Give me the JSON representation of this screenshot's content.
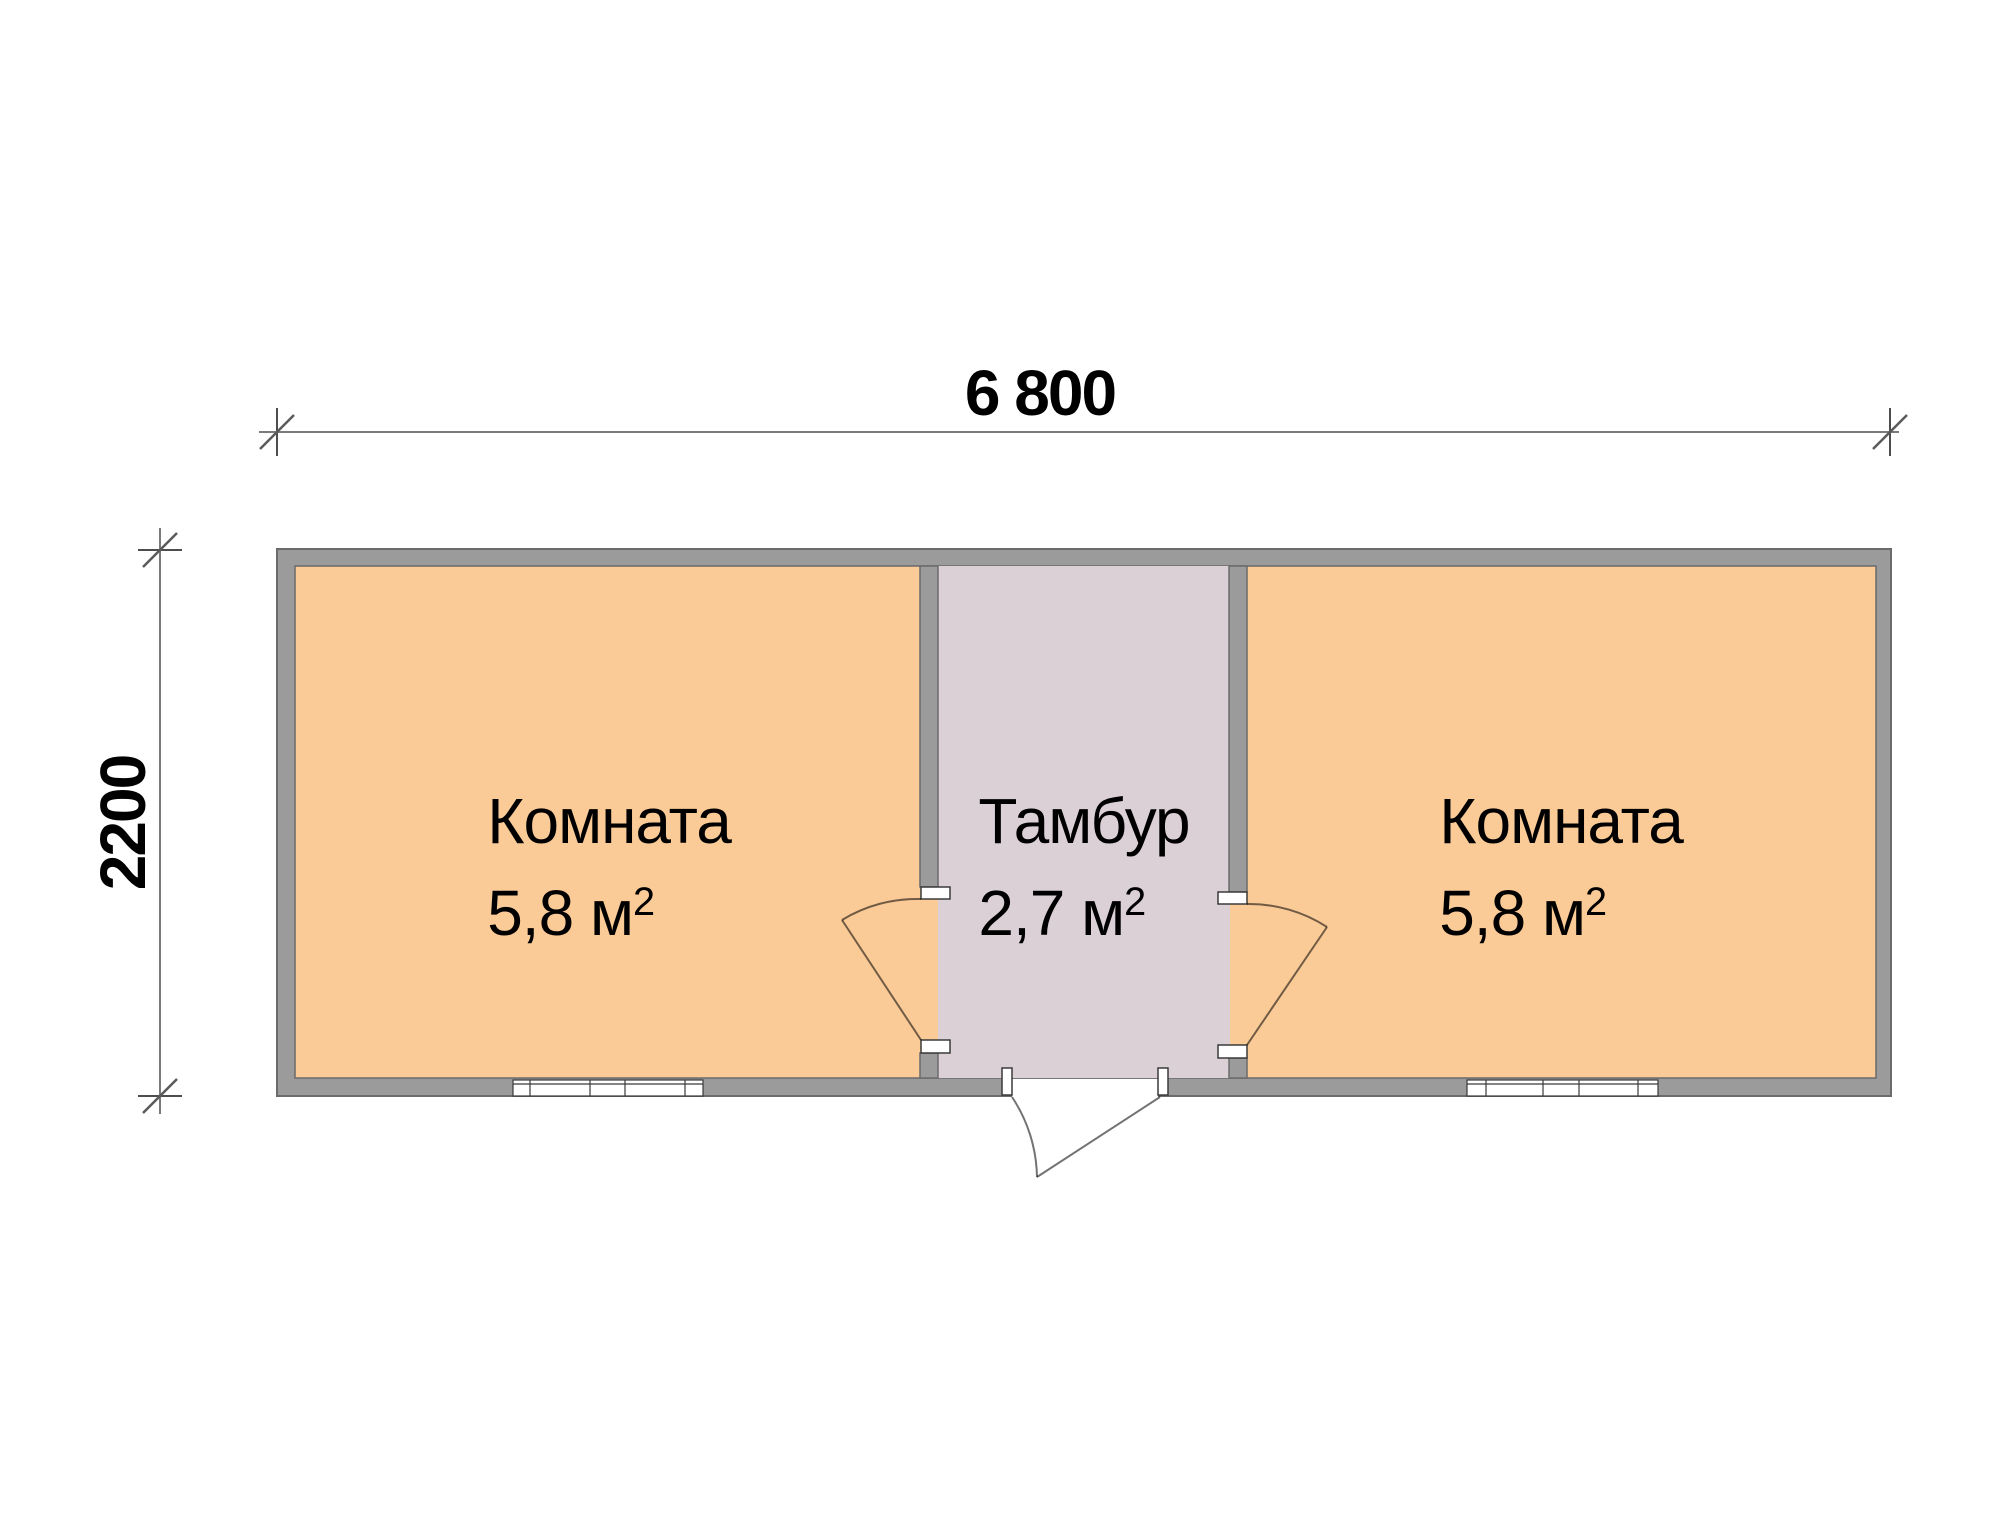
{
  "plan": {
    "kind": "floor-plan",
    "dimensions": {
      "width_label": "6 800",
      "height_label": "2200"
    },
    "rooms": [
      {
        "id": "room-left",
        "name": "Комната",
        "area_value": "5,8 м",
        "area_sup": "2"
      },
      {
        "id": "vestibule",
        "name": "Тамбур",
        "area_value": "2,7 м",
        "area_sup": "2"
      },
      {
        "id": "room-right",
        "name": "Комната",
        "area_value": "5,8 м",
        "area_sup": "2"
      }
    ],
    "colors": {
      "room_fill": "#FACB97",
      "vestibule_fill": "#DCD0D7",
      "wall_fill": "#9B9B9B",
      "wall_outline": "#6B6B6B",
      "dimension_line": "#7A7A7A",
      "text": "#000000",
      "background": "#FFFFFF"
    }
  }
}
